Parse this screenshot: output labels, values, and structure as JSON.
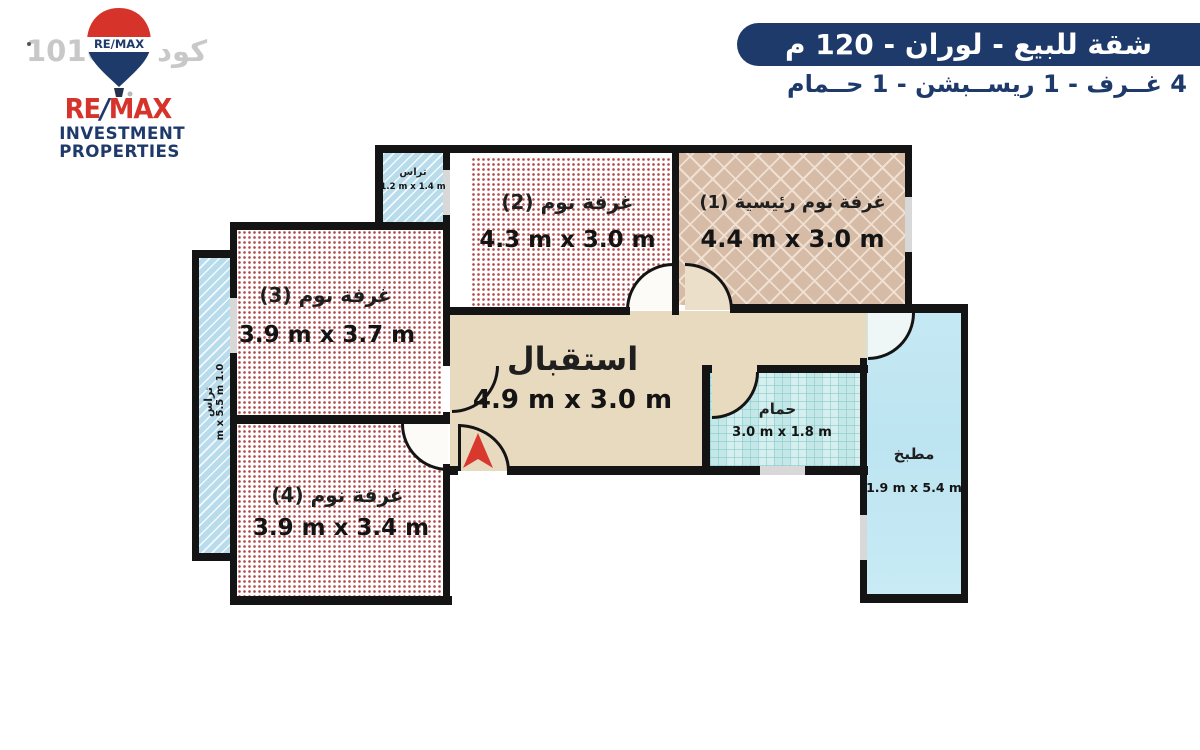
{
  "watermark": "كود 101603",
  "logo": {
    "balloon_label": "RE/MAX",
    "brand_re": "RE",
    "brand_slash": "/",
    "brand_max": "MAX",
    "line1": "INVESTMENT",
    "line2": "PROPERTIES"
  },
  "header": {
    "title": "شقة للبيع - لوران - 120 م",
    "subtitle": "4 غــرف - 1 ريســبشن - 1 حــمام"
  },
  "rooms": {
    "terrace_top": {
      "name": "تراس",
      "dims": "1.2 m x 1.4 m"
    },
    "bedroom2": {
      "name": "غرفة نوم (2)",
      "dims": "4.3 m x 3.0 m"
    },
    "master_bedroom": {
      "name": "غرفة نوم رئيسية (1)",
      "dims": "4.4 m x 3.0 m"
    },
    "bedroom3": {
      "name": "غرفة نوم (3)",
      "dims": "3.9 m x 3.7 m"
    },
    "terrace_left": {
      "name": "تراس",
      "dims": "1.0 m x 5.5 m"
    },
    "bedroom4": {
      "name": "غرفة نوم (4)",
      "dims": "3.9 m x 3.4 m"
    },
    "reception": {
      "name": "استقبال",
      "dims": "4.9 m x 3.0 m"
    },
    "bathroom": {
      "name": "حمام",
      "dims": "3.0 m x 1.8 m"
    },
    "kitchen": {
      "name": "مطبخ",
      "dims": "1.9 m x 5.4 m"
    }
  },
  "colors": {
    "banner_navy": "#1e3a6b",
    "logo_red": "#d6332a",
    "wall_black": "#141414",
    "reception_beige": "#e8dabf",
    "terrace_blue": "#b9dcec",
    "bathroom_teal": "#d4efee",
    "kitchen_blue": "#c3e8f4",
    "herringbone_tan": "#d6bba6",
    "dot_red": "#a12828",
    "entry_arrow_red": "#d8382e",
    "watermark_gray": "#c8c8c8"
  }
}
